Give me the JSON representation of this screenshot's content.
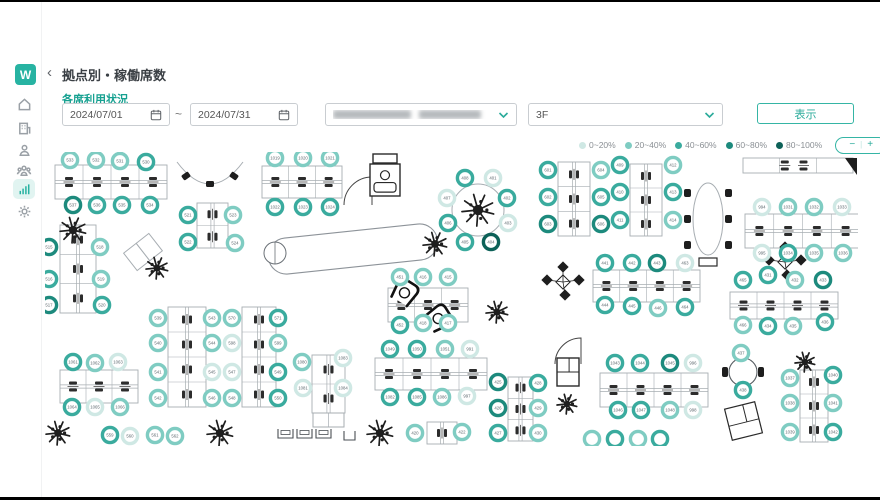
{
  "sidebar": {
    "logo": "W",
    "items": [
      {
        "name": "home"
      },
      {
        "name": "office-building"
      },
      {
        "name": "user"
      },
      {
        "name": "members"
      },
      {
        "name": "analytics",
        "active": true
      },
      {
        "name": "settings"
      }
    ]
  },
  "header": {
    "back": "‹",
    "title": "拠点別・稼働席数"
  },
  "filters": {
    "section_label": "各席利用状況",
    "date_from": "2024/07/01",
    "date_to": "2024/07/31",
    "range_separator": "~",
    "location_redacted": true,
    "floor": "3F",
    "submit_label": "表示"
  },
  "legend": {
    "items": [
      {
        "label": "0~20%",
        "color": "#cfe8e4"
      },
      {
        "label": "20~40%",
        "color": "#7fccc2"
      },
      {
        "label": "40~60%",
        "color": "#3aab9e"
      },
      {
        "label": "60~80%",
        "color": "#1d8a7d"
      },
      {
        "label": "80~100%",
        "color": "#0d6158"
      }
    ],
    "zoom_out": "−",
    "zoom_divider": "|",
    "zoom_in": "+"
  },
  "map": {
    "width": 813,
    "height": 294,
    "palette": {
      "levels": [
        "#cfe8e4",
        "#7fccc2",
        "#3aab9e",
        "#1d8a7d",
        "#0d6158"
      ],
      "desk": "#a7adb2",
      "glyph": "#2c2c2c",
      "number": "#5f6a70",
      "accent": "#27b3a2"
    },
    "desks": [
      [
        10,
        13,
        112,
        34,
        "h",
        4
      ],
      [
        217,
        14,
        80,
        32,
        "h",
        3
      ],
      [
        513,
        10,
        32,
        74,
        "v",
        3
      ],
      [
        585,
        12,
        32,
        72,
        "v",
        3
      ],
      [
        700,
        62,
        115,
        34,
        "h",
        4
      ],
      [
        15,
        73,
        36,
        88,
        "v",
        3
      ],
      [
        152,
        51,
        31,
        45,
        "v",
        2
      ],
      [
        123,
        155,
        38,
        100,
        "v",
        4
      ],
      [
        197,
        155,
        34,
        100,
        "v",
        4
      ],
      [
        15,
        218,
        78,
        33,
        "h",
        3
      ],
      [
        267,
        203,
        33,
        58,
        "v",
        2
      ],
      [
        343,
        136,
        80,
        34,
        "h",
        3
      ],
      [
        330,
        206,
        112,
        32,
        "h",
        4
      ],
      [
        548,
        118,
        107,
        32,
        "h",
        4
      ],
      [
        685,
        140,
        108,
        27,
        "h",
        4
      ],
      [
        555,
        221,
        108,
        34,
        "h",
        4
      ],
      [
        463,
        225,
        25,
        64,
        "v",
        3
      ],
      [
        755,
        218,
        28,
        72,
        "v",
        3
      ],
      [
        382,
        270,
        30,
        22,
        "v",
        1
      ]
    ],
    "furniture": [
      [
        "plant",
        28,
        78,
        13
      ],
      [
        "bench",
        165,
        10
      ],
      [
        "door",
        327,
        53,
        28
      ],
      [
        "copier",
        325,
        12,
        30,
        32,
        1
      ],
      [
        "rtable",
        433,
        58,
        26,
        1
      ],
      [
        "oval",
        663,
        67,
        15,
        36
      ],
      [
        "counter",
        698,
        6,
        110,
        15
      ],
      [
        "wedge",
        800,
        6
      ],
      [
        "tilted",
        98,
        100
      ],
      [
        "plant",
        112,
        116,
        11
      ],
      [
        "capsule",
        308,
        97,
        170,
        36,
        -6
      ],
      [
        "stool",
        230,
        101,
        11
      ],
      [
        "plant",
        390,
        92,
        12
      ],
      [
        "armchairs",
        360,
        140
      ],
      [
        "plant",
        452,
        160,
        11
      ],
      [
        "diamonds",
        518,
        130
      ],
      [
        "diamonds",
        740,
        110
      ],
      [
        "door",
        536,
        212,
        26
      ],
      [
        "copier",
        512,
        206,
        22,
        28,
        2
      ],
      [
        "plant",
        522,
        252,
        10
      ],
      [
        "rtable2",
        698,
        220,
        14
      ],
      [
        "cabinet",
        683,
        253,
        31,
        32,
        -14
      ],
      [
        "plant",
        760,
        210,
        10
      ],
      [
        "lockers",
        233,
        277
      ],
      [
        "cab2",
        268,
        261,
        31,
        14
      ],
      [
        "plant",
        13,
        281,
        12
      ],
      [
        "plant",
        175,
        281,
        13
      ],
      [
        "plant",
        335,
        281,
        13
      ]
    ],
    "seats": [
      [
        "533",
        25,
        8,
        2
      ],
      [
        "532",
        51,
        8,
        2
      ],
      [
        "531",
        75,
        9,
        2
      ],
      [
        "530",
        101,
        10,
        3
      ],
      [
        "537",
        28,
        53,
        4
      ],
      [
        "536",
        52,
        53,
        3
      ],
      [
        "535",
        77,
        53,
        3
      ],
      [
        "534",
        105,
        53,
        3
      ],
      [
        "1019",
        230,
        6,
        2
      ],
      [
        "1020",
        258,
        6,
        2
      ],
      [
        "1021",
        285,
        6,
        2
      ],
      [
        "1022",
        230,
        55,
        3
      ],
      [
        "1023",
        258,
        55,
        3
      ],
      [
        "1024",
        285,
        55,
        3
      ],
      [
        "401",
        448,
        26,
        1
      ],
      [
        "402",
        462,
        46,
        3
      ],
      [
        "403",
        463,
        71,
        1
      ],
      [
        "404",
        446,
        90,
        5
      ],
      [
        "405",
        420,
        90,
        3
      ],
      [
        "406",
        403,
        71,
        3
      ],
      [
        "407",
        402,
        46,
        1
      ],
      [
        "408",
        420,
        26,
        3
      ],
      [
        "601",
        503,
        18,
        3
      ],
      [
        "602",
        503,
        45,
        3
      ],
      [
        "603",
        503,
        72,
        4
      ],
      [
        "604",
        556,
        18,
        2
      ],
      [
        "605",
        556,
        45,
        3
      ],
      [
        "606",
        556,
        72,
        4
      ],
      [
        "409",
        575,
        13,
        3
      ],
      [
        "410",
        575,
        40,
        3
      ],
      [
        "411",
        575,
        68,
        3
      ],
      [
        "412",
        628,
        13,
        2
      ],
      [
        "413",
        628,
        40,
        3
      ],
      [
        "414",
        628,
        68,
        2
      ],
      [
        "994",
        717,
        55,
        1
      ],
      [
        "1031",
        743,
        55,
        2
      ],
      [
        "1032",
        769,
        55,
        2
      ],
      [
        "1033",
        797,
        55,
        1
      ],
      [
        "995",
        717,
        101,
        1
      ],
      [
        "1034",
        743,
        101,
        3
      ],
      [
        "1035",
        769,
        101,
        2
      ],
      [
        "1036",
        798,
        101,
        2
      ],
      [
        "515",
        4,
        95,
        4
      ],
      [
        "516",
        4,
        127,
        3
      ],
      [
        "517",
        4,
        153,
        4
      ],
      [
        "518",
        55,
        95,
        2
      ],
      [
        "519",
        56,
        127,
        2
      ],
      [
        "520",
        57,
        153,
        3
      ],
      [
        "521",
        143,
        63,
        3
      ],
      [
        "522",
        143,
        90,
        3
      ],
      [
        "523",
        188,
        63,
        2
      ],
      [
        "524",
        190,
        91,
        2
      ],
      [
        "539",
        113,
        166,
        2
      ],
      [
        "540",
        113,
        191,
        2
      ],
      [
        "541",
        113,
        220,
        2
      ],
      [
        "542",
        113,
        246,
        2
      ],
      [
        "543",
        167,
        166,
        2
      ],
      [
        "544",
        167,
        191,
        2
      ],
      [
        "545",
        167,
        220,
        1
      ],
      [
        "546",
        167,
        246,
        2
      ],
      [
        "570",
        187,
        166,
        2
      ],
      [
        "598",
        187,
        191,
        1
      ],
      [
        "547",
        187,
        220,
        1
      ],
      [
        "548",
        187,
        246,
        2
      ],
      [
        "571",
        233,
        166,
        3
      ],
      [
        "599",
        233,
        191,
        2
      ],
      [
        "549",
        233,
        220,
        3
      ],
      [
        "550",
        233,
        246,
        3
      ],
      [
        "1061",
        28,
        210,
        3
      ],
      [
        "1062",
        50,
        211,
        2
      ],
      [
        "1063",
        73,
        210,
        1
      ],
      [
        "1064",
        27,
        255,
        3
      ],
      [
        "1065",
        50,
        255,
        1
      ],
      [
        "1066",
        75,
        255,
        2
      ],
      [
        "559",
        65,
        283,
        3
      ],
      [
        "560",
        85,
        284,
        1
      ],
      [
        "561",
        110,
        283,
        2
      ],
      [
        "562",
        130,
        284,
        2
      ],
      [
        "1080",
        257,
        210,
        2
      ],
      [
        "1081",
        258,
        236,
        1
      ],
      [
        "1083",
        298,
        206,
        1
      ],
      [
        "1084",
        298,
        236,
        1
      ],
      [
        "451",
        355,
        125,
        2
      ],
      [
        "416",
        378,
        125,
        2
      ],
      [
        "415",
        403,
        125,
        2
      ],
      [
        "452",
        355,
        173,
        3
      ],
      [
        "418",
        378,
        171,
        2
      ],
      [
        "417",
        403,
        171,
        2
      ],
      [
        "1049",
        345,
        197,
        3
      ],
      [
        "1050",
        372,
        197,
        3
      ],
      [
        "1051",
        400,
        197,
        2
      ],
      [
        "991",
        425,
        197,
        1
      ],
      [
        "1082",
        345,
        245,
        3
      ],
      [
        "1085",
        372,
        245,
        3
      ],
      [
        "1086",
        397,
        245,
        2
      ],
      [
        "997",
        422,
        244,
        1
      ],
      [
        "441",
        560,
        111,
        3
      ],
      [
        "442",
        587,
        111,
        3
      ],
      [
        "443",
        612,
        111,
        4
      ],
      [
        "463",
        640,
        111,
        1
      ],
      [
        "444",
        560,
        153,
        3
      ],
      [
        "445",
        587,
        154,
        3
      ],
      [
        "446",
        613,
        156,
        2
      ],
      [
        "464",
        640,
        155,
        3
      ],
      [
        "465",
        698,
        128,
        3
      ],
      [
        "431",
        723,
        123,
        3
      ],
      [
        "432",
        750,
        128,
        2
      ],
      [
        "433",
        778,
        128,
        4
      ],
      [
        "466",
        698,
        173,
        2
      ],
      [
        "434",
        723,
        174,
        3
      ],
      [
        "435",
        748,
        174,
        2
      ],
      [
        "436",
        780,
        170,
        3
      ],
      [
        "1043",
        570,
        211,
        3
      ],
      [
        "1044",
        595,
        211,
        3
      ],
      [
        "1045",
        625,
        211,
        4
      ],
      [
        "996",
        648,
        211,
        1
      ],
      [
        "1046",
        573,
        258,
        3
      ],
      [
        "1047",
        596,
        258,
        3
      ],
      [
        "1048",
        625,
        258,
        2
      ],
      [
        "998",
        648,
        258,
        1
      ],
      [
        "437",
        696,
        201,
        2
      ],
      [
        "438",
        698,
        238,
        3
      ],
      [
        "425",
        453,
        230,
        4
      ],
      [
        "426",
        453,
        256,
        4
      ],
      [
        "427",
        453,
        281,
        3
      ],
      [
        "428",
        493,
        231,
        3
      ],
      [
        "429",
        493,
        256,
        2
      ],
      [
        "430",
        493,
        281,
        2
      ],
      [
        "1037",
        745,
        226,
        2
      ],
      [
        "1038",
        745,
        251,
        2
      ],
      [
        "1039",
        745,
        280,
        2
      ],
      [
        "1040",
        788,
        223,
        3
      ],
      [
        "1041",
        788,
        251,
        2
      ],
      [
        "1042",
        788,
        280,
        3
      ],
      [
        "420",
        370,
        281,
        2
      ],
      [
        "422",
        417,
        280,
        2
      ],
      [
        "",
        547,
        287,
        2
      ],
      [
        "",
        570,
        287,
        3
      ],
      [
        "",
        593,
        287,
        2
      ],
      [
        "",
        615,
        287,
        3
      ]
    ]
  }
}
